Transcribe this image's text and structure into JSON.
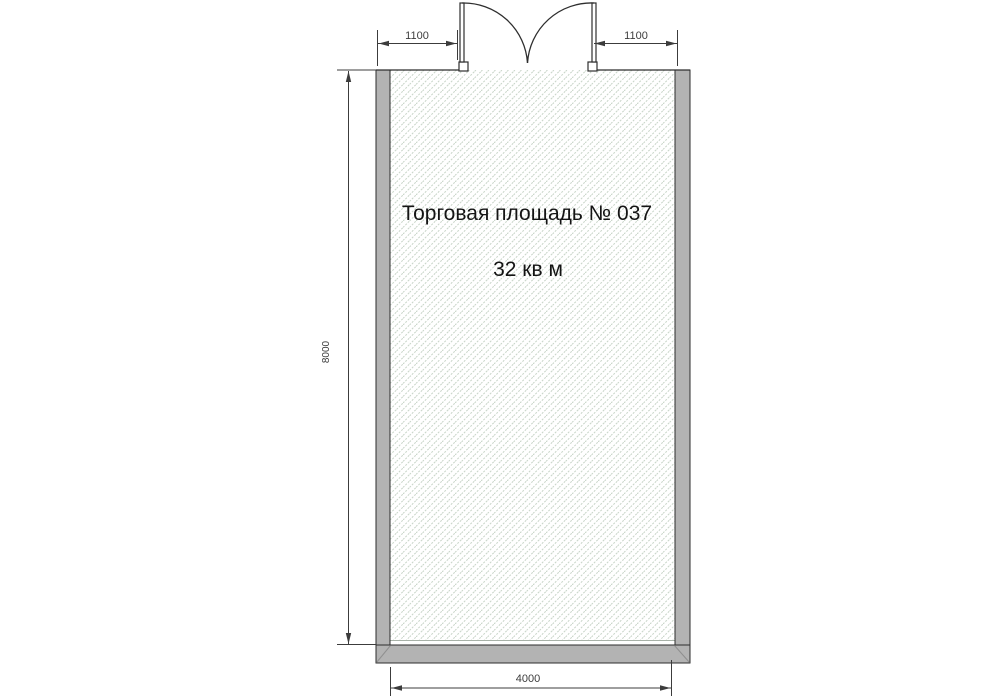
{
  "plan": {
    "room": {
      "title": "Торговая площадь № 037",
      "area": "32 кв м"
    },
    "dimensions": {
      "door_offset_left": "1100",
      "door_offset_right": "1100",
      "depth": "8000",
      "width": "4000"
    },
    "colors": {
      "wall_fill": "#b3b3b3",
      "outline": "#2e2e2e",
      "hatch_line": "#c7d4c7",
      "dim_line": "#3c3c3c",
      "label_text": "#141414",
      "miter_line": "#8f8f8f",
      "floor_edge": "#a8b2a8",
      "background": "#ffffff"
    }
  }
}
